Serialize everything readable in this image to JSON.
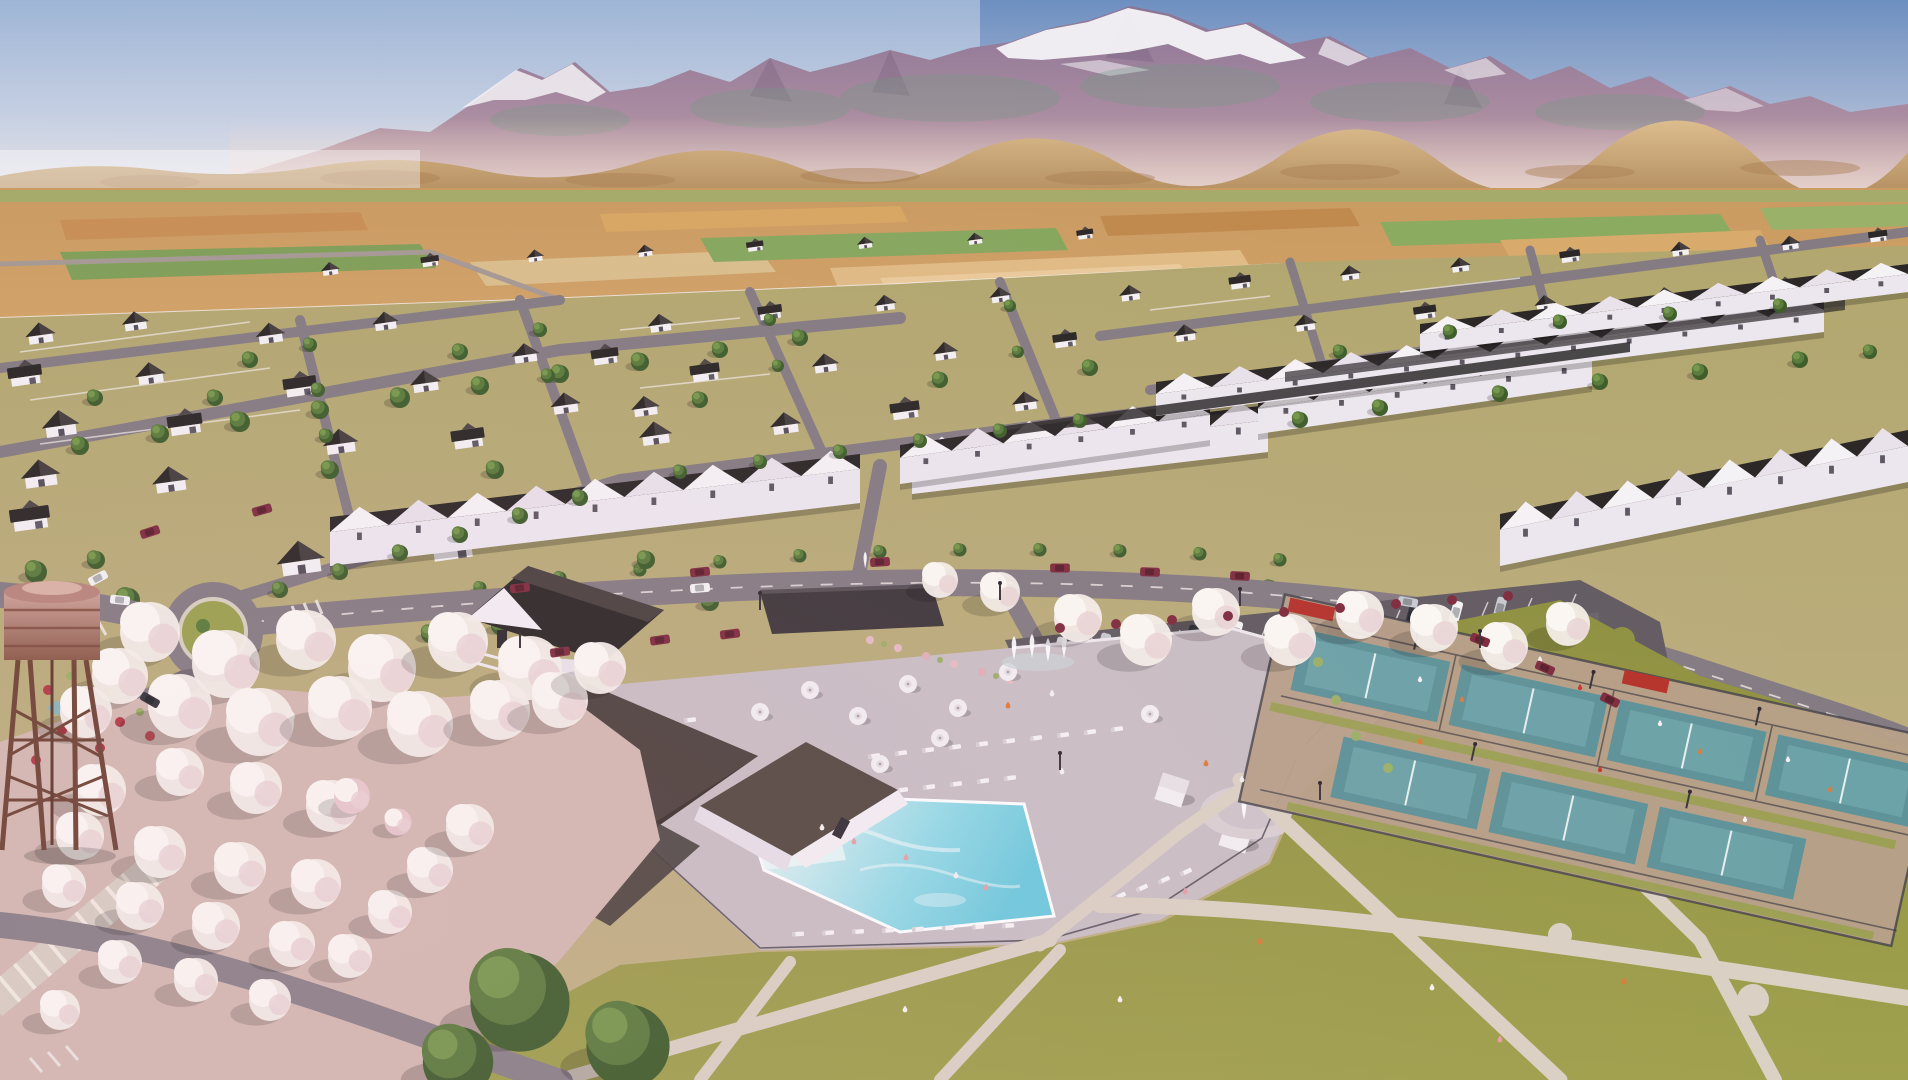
{
  "scene": {
    "type": "architectural aerial rendering",
    "description": "Aerial 3D rendering of a master-planned residential community: rows of white farmhouse-style homes and townhomes, a clubhouse with swimming pool and splash pad, an angled parking lot full of cars, pickleball courts, large lawns with walking paths, an orchard of white flowering trees, a rusty water tower, orange farmland and hazy snow-capped mountains across the horizon under a blue sky.",
    "regions": [
      "sky",
      "mountain-range",
      "foothills",
      "farmland",
      "neighborhood",
      "townhome-rows",
      "main-road",
      "roundabout",
      "parking-lot",
      "clubhouse",
      "swimming-pool",
      "splash-pad",
      "lawn",
      "walking-paths",
      "pickleball-courts",
      "orchard",
      "blossom-trees",
      "water-tower"
    ]
  },
  "palette": {
    "sky_top": "#6d8fc0",
    "sky_haze": "#e9e2e6",
    "mountain": "#9a81a0",
    "snow": "#f3f1f5",
    "foothill": "#c9a070",
    "field_orange": "#d29a58",
    "field_green": "#84a35c",
    "ground": "#b2a76f",
    "lawn": "#8e9140",
    "path": "#dbd1c4",
    "street": "#857c83",
    "asphalt": "#635c62",
    "roof_dark": "#2c2827",
    "roof_light": "#554c49",
    "wall_white": "#f3f0f3",
    "wall_shade": "#d7cfda",
    "pool_water": "#8fd9e6",
    "pool_shallow": "#e8f5f5",
    "deck": "#c9bfc5",
    "court_teal": "#5e9399",
    "court_apron": "#b7a089",
    "tree_green": "#5a7c3c",
    "tree_dark": "#3f5e2c",
    "blossom": "#f4efe9",
    "blossom_pink": "#e9c9ce",
    "shrub_red": "#7e2d3e",
    "orchard_ground": "#d3bab2",
    "tower_rust": "#6e4434",
    "tower_tank": "#c3948a",
    "car_red": "#c1271d",
    "umbrella": "#f2eff2"
  }
}
